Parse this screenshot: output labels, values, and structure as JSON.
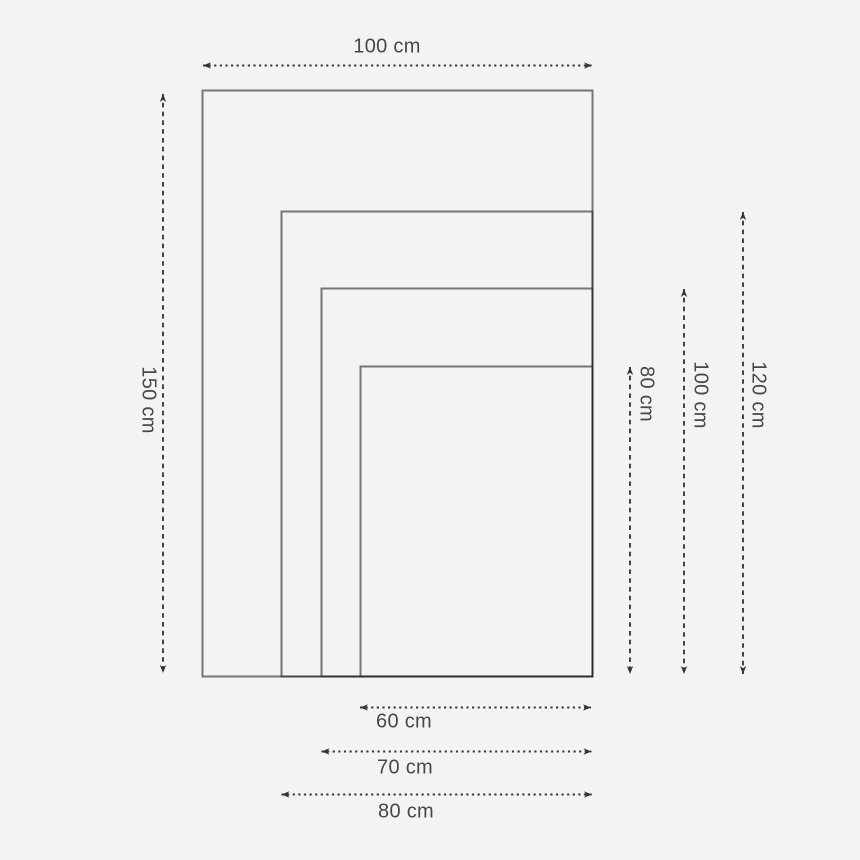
{
  "diagram": {
    "type": "nested-size-comparison",
    "unit": "cm",
    "sizes": [
      {
        "width_cm": 100,
        "height_cm": 150,
        "width_label": "100 cm",
        "height_label": "150 cm"
      },
      {
        "width_cm": 80,
        "height_cm": 120,
        "width_label": "80 cm",
        "height_label": "120 cm"
      },
      {
        "width_cm": 70,
        "height_cm": 100,
        "width_label": "70 cm",
        "height_label": "100 cm"
      },
      {
        "width_cm": 60,
        "height_cm": 80,
        "width_label": "60 cm",
        "height_label": "80 cm"
      }
    ],
    "labels": {
      "top_width": "100 cm",
      "left_height": "150 cm",
      "right_heights": [
        "80 cm",
        "100 cm",
        "120 cm"
      ],
      "bottom_widths": [
        "60 cm",
        "70 cm",
        "80 cm"
      ]
    },
    "colors": {
      "background": "#f4f3f1",
      "rect_stroke": "#787878",
      "shared_edge_stroke": "#2b2b2b",
      "arrow": "#3a3a3a",
      "text": "#484848"
    }
  }
}
